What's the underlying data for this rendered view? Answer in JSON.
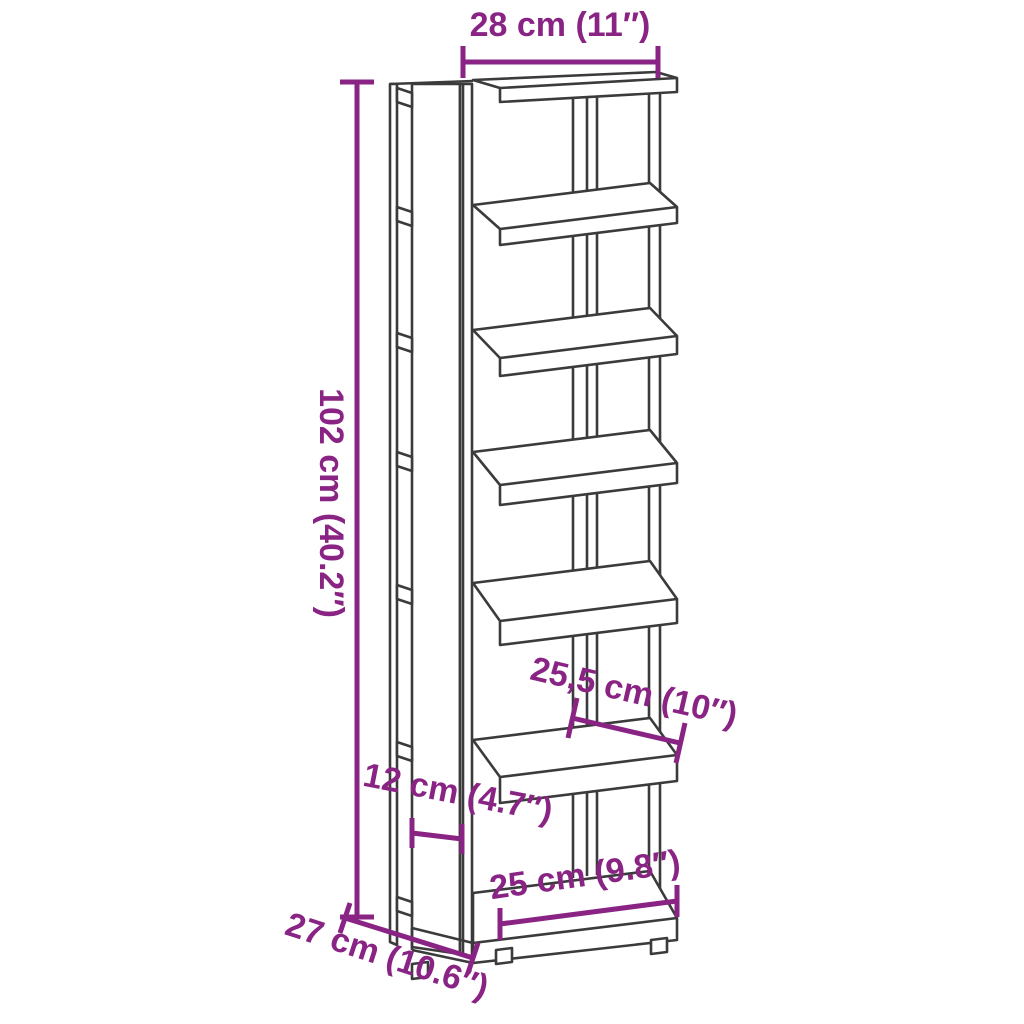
{
  "colors": {
    "dimension_accent": "#8A2484",
    "line_art": "#3B3B3B",
    "background": "#FFFFFF"
  },
  "dimensions": {
    "top_width": "28 cm (11″)",
    "height": "102 cm (40.2″)",
    "inner_width": "25,5 cm (10″)",
    "side_depth": "12 cm (4.7″)",
    "bottom_width": "25 cm (9.8″)",
    "depth": "27 cm (10.6″)"
  }
}
